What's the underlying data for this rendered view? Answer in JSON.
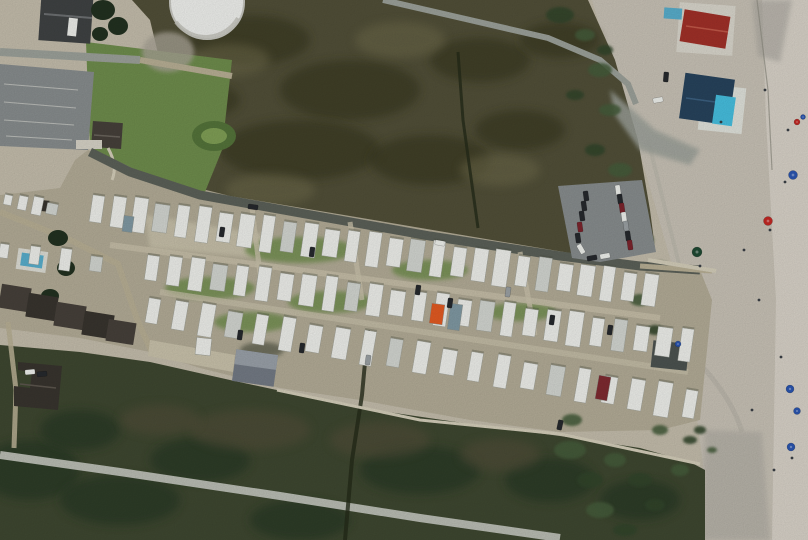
{
  "meta": {
    "description": "Top-down aerial photograph of an oceanfront RV / mobile-home park set between a brown salt marsh and a sandy beach; rows of white travel trailers, a water tank, parking lots, houses with pools, beach boardwalks and beachgoers with umbrellas.",
    "view": "vertical aerial photo",
    "counts": {
      "trailers": 91,
      "houses": 8,
      "pools": 3,
      "parked_cars": 32,
      "beach_umbrellas": 9
    }
  },
  "palette": {
    "white": "#eeefec",
    "beachSand": "#c7c1b5",
    "beachSandLight": "#d8d3c9",
    "beachTrack": "#a7a49d",
    "trackGray": "#b2aea4",
    "duneSand": "#c3bcab",
    "marshNorth": "#514f38",
    "marshNorthDark": "#34341f",
    "marshNorthLight": "#6e6a4b",
    "marshSouth": "#3e4730",
    "marshSouthDark": "#243420",
    "marshSouthBrown": "#55503a",
    "grass": "#6e8c4c",
    "grassDark": "#54733a",
    "grassMoundInner": "#7f9e55",
    "treeDark": "#223120",
    "rvGround": "#b2ab96",
    "laneTan": "#c8c1aa",
    "dirtTan": "#b7ae94",
    "dirtGray": "#a8a395",
    "roadAsphalt": "#5b6058",
    "roadLight": "#9ba099",
    "roadSouth": "#b9bcb3",
    "parkingGray": "#878c8d",
    "trailerWhite": "#edeeea",
    "trailerGray": "#d2d5d0",
    "trailerShadow": "#4e5244",
    "buildingDark": "#3f4243",
    "roofBrown": "#46403a",
    "roofBrown2": "#38342e",
    "officeRoofLight": "#99a0a8",
    "officeRoofDark": "#737a84",
    "shedDark": "#4c5350",
    "redRoof": "#a03028",
    "tealRoof": "#27435c",
    "pool": "#58adcb",
    "poolBright": "#46bede",
    "boardwalk": "#d3cdb9",
    "ditch": "#242a19",
    "carDark": "#26292d",
    "carMaroon": "#7c242c",
    "carWhite": "#eef0ec",
    "carGray": "#9aa0a3",
    "umbBlue": "#2a55b0",
    "umbRed": "#c32823",
    "umbGreen": "#1f4a33",
    "orangeTrailer": "#e25a22",
    "tealTrailer": "#7f98a2",
    "maroonTrailer": "#7e2a30",
    "shrub": "#455c3a",
    "shrubDark": "#31452c",
    "person": "#3a3f45"
  },
  "scene": {
    "trailer_rows": [
      {
        "name": "west-row-1",
        "x0": 8,
        "y0": 200,
        "x1": 52,
        "y1": 209,
        "count": 4,
        "wid": 9,
        "len": 15
      },
      {
        "name": "west-row-2",
        "x0": 4,
        "y0": 251,
        "x1": 96,
        "y1": 264,
        "count": 4,
        "wid": 10,
        "len": 19
      },
      {
        "name": "row-1",
        "x0": 97,
        "y0": 209,
        "x1": 650,
        "y1": 290,
        "count": 27,
        "wid": 13,
        "len": 32
      },
      {
        "name": "row-2",
        "x0": 152,
        "y0": 268,
        "x1": 686,
        "y1": 345,
        "count": 25,
        "wid": 13,
        "len": 30
      },
      {
        "name": "row-3",
        "x0": 153,
        "y0": 311,
        "x1": 690,
        "y1": 404,
        "count": 21,
        "wid": 13,
        "len": 30
      }
    ],
    "special_trailers": [
      {
        "x": 437,
        "y": 314,
        "w": 13,
        "h": 20,
        "a": 8,
        "color": "orangeTrailer"
      },
      {
        "x": 455,
        "y": 317,
        "w": 12,
        "h": 26,
        "a": 8,
        "color": "tealTrailer"
      },
      {
        "x": 603,
        "y": 388,
        "w": 12,
        "h": 24,
        "a": 10,
        "color": "maroonTrailer"
      },
      {
        "x": 128,
        "y": 224,
        "w": 10,
        "h": 16,
        "a": 8,
        "color": "tealTrailer"
      }
    ],
    "parking_cars": [
      {
        "x": 586,
        "y": 196,
        "a": -8,
        "color": "carDark"
      },
      {
        "x": 584,
        "y": 206,
        "a": -8,
        "color": "carDark"
      },
      {
        "x": 582,
        "y": 216,
        "a": -8,
        "color": "carDark"
      },
      {
        "x": 580,
        "y": 227,
        "a": -8,
        "color": "carMaroon"
      },
      {
        "x": 578,
        "y": 238,
        "a": -8,
        "color": "carDark"
      },
      {
        "x": 581,
        "y": 249,
        "a": -30,
        "color": "carWhite"
      },
      {
        "x": 618,
        "y": 190,
        "a": -8,
        "color": "carWhite"
      },
      {
        "x": 620,
        "y": 199,
        "a": -8,
        "color": "carDark"
      },
      {
        "x": 622,
        "y": 208,
        "a": -8,
        "color": "carMaroon"
      },
      {
        "x": 624,
        "y": 217,
        "a": -8,
        "color": "carWhite"
      },
      {
        "x": 626,
        "y": 226,
        "a": -8,
        "color": "carGray"
      },
      {
        "x": 628,
        "y": 236,
        "a": -8,
        "color": "carDark"
      },
      {
        "x": 630,
        "y": 245,
        "a": -8,
        "color": "carMaroon"
      },
      {
        "x": 605,
        "y": 256,
        "a": 80,
        "color": "carWhite"
      },
      {
        "x": 592,
        "y": 258,
        "a": 80,
        "color": "carDark"
      }
    ],
    "road_cars": [
      {
        "x": 440,
        "y": 243,
        "a": 100,
        "color": "carWhite"
      },
      {
        "x": 253,
        "y": 207,
        "a": 98,
        "color": "carDark"
      }
    ],
    "park_cars": [
      {
        "x": 222,
        "y": 232,
        "a": 8,
        "color": "carDark"
      },
      {
        "x": 312,
        "y": 252,
        "a": 8,
        "color": "carDark"
      },
      {
        "x": 418,
        "y": 290,
        "a": 8,
        "color": "carDark"
      },
      {
        "x": 450,
        "y": 303,
        "a": 8,
        "color": "carDark"
      },
      {
        "x": 508,
        "y": 292,
        "a": 8,
        "color": "carGray"
      },
      {
        "x": 552,
        "y": 320,
        "a": 8,
        "color": "carDark"
      },
      {
        "x": 610,
        "y": 330,
        "a": 8,
        "color": "carDark"
      },
      {
        "x": 240,
        "y": 335,
        "a": 8,
        "color": "carDark"
      },
      {
        "x": 302,
        "y": 348,
        "a": 8,
        "color": "carDark"
      },
      {
        "x": 368,
        "y": 360,
        "a": 8,
        "color": "carGray"
      },
      {
        "x": 560,
        "y": 425,
        "a": 12,
        "color": "carDark"
      },
      {
        "x": 666,
        "y": 77,
        "a": 5,
        "color": "carDark"
      },
      {
        "x": 658,
        "y": 100,
        "a": 80,
        "color": "carWhite"
      },
      {
        "x": 30,
        "y": 372,
        "a": 85,
        "color": "carWhite"
      },
      {
        "x": 42,
        "y": 374,
        "a": 85,
        "color": "carDark"
      }
    ],
    "umbrellas": [
      {
        "x": 793,
        "y": 175,
        "r": 4.5,
        "color": "umbBlue"
      },
      {
        "x": 768,
        "y": 221,
        "r": 4.5,
        "color": "umbRed"
      },
      {
        "x": 697,
        "y": 252,
        "r": 5,
        "color": "umbGreen"
      },
      {
        "x": 790,
        "y": 389,
        "r": 4,
        "color": "umbBlue"
      },
      {
        "x": 797,
        "y": 411,
        "r": 3.5,
        "color": "umbBlue"
      },
      {
        "x": 791,
        "y": 447,
        "r": 4,
        "color": "umbBlue"
      },
      {
        "x": 797,
        "y": 122,
        "r": 3,
        "color": "umbRed"
      },
      {
        "x": 803,
        "y": 117,
        "r": 2.5,
        "color": "umbBlue"
      },
      {
        "x": 678,
        "y": 344,
        "r": 3,
        "color": "umbBlue"
      }
    ],
    "people": [
      [
        785,
        182
      ],
      [
        770,
        230
      ],
      [
        759,
        300
      ],
      [
        781,
        357
      ],
      [
        792,
        458
      ],
      [
        700,
        266
      ],
      [
        721,
        122
      ],
      [
        765,
        90
      ],
      [
        788,
        130
      ],
      [
        752,
        410
      ],
      [
        774,
        470
      ],
      [
        744,
        250
      ]
    ],
    "shrubs": [
      [
        560,
        15,
        14,
        8
      ],
      [
        585,
        35,
        10,
        6
      ],
      [
        605,
        50,
        8,
        5
      ],
      [
        600,
        70,
        12,
        7
      ],
      [
        575,
        95,
        9,
        5
      ],
      [
        610,
        110,
        11,
        6
      ],
      [
        595,
        150,
        10,
        6
      ],
      [
        620,
        170,
        12,
        7
      ],
      [
        630,
        210,
        10,
        6
      ],
      [
        645,
        240,
        9,
        5
      ],
      [
        660,
        265,
        8,
        4
      ],
      [
        640,
        300,
        10,
        6
      ],
      [
        655,
        330,
        8,
        5
      ],
      [
        570,
        450,
        16,
        9
      ],
      [
        590,
        480,
        13,
        8
      ],
      [
        615,
        460,
        11,
        7
      ],
      [
        640,
        480,
        12,
        7
      ],
      [
        600,
        510,
        14,
        8
      ],
      [
        655,
        505,
        10,
        6
      ],
      [
        680,
        470,
        9,
        6
      ],
      [
        625,
        530,
        12,
        6
      ],
      [
        660,
        430,
        8,
        5
      ],
      [
        690,
        440,
        7,
        4
      ],
      [
        572,
        420,
        10,
        6
      ],
      [
        700,
        430,
        6,
        4
      ],
      [
        712,
        450,
        5,
        3
      ]
    ],
    "marsh_patches_dark": [
      [
        250,
        40,
        60,
        25
      ],
      [
        350,
        90,
        70,
        30
      ],
      [
        480,
        60,
        50,
        22
      ],
      [
        300,
        150,
        80,
        30
      ],
      [
        430,
        160,
        60,
        25
      ],
      [
        200,
        100,
        40,
        18
      ],
      [
        520,
        130,
        45,
        20
      ],
      [
        560,
        40,
        40,
        18
      ],
      [
        30,
        470,
        50,
        30
      ],
      [
        120,
        500,
        60,
        25
      ],
      [
        80,
        430,
        40,
        20
      ],
      [
        200,
        460,
        50,
        22
      ],
      [
        420,
        470,
        60,
        24
      ],
      [
        300,
        520,
        50,
        20
      ],
      [
        550,
        480,
        45,
        22
      ],
      [
        640,
        500,
        40,
        20
      ]
    ],
    "marsh_patches_light": [
      [
        230,
        60,
        40,
        16
      ],
      [
        400,
        40,
        45,
        18
      ],
      [
        500,
        170,
        40,
        16
      ],
      [
        270,
        190,
        45,
        16
      ],
      [
        180,
        160,
        35,
        14
      ],
      [
        250,
        430,
        60,
        20
      ],
      [
        380,
        440,
        50,
        18
      ],
      [
        500,
        455,
        40,
        16
      ],
      [
        160,
        420,
        40,
        15
      ]
    ],
    "grass_patches": [
      [
        300,
        250,
        55,
        13
      ],
      [
        210,
        288,
        45,
        11
      ],
      [
        430,
        270,
        38,
        10
      ],
      [
        330,
        302,
        42,
        11
      ],
      [
        520,
        312,
        36,
        9
      ],
      [
        252,
        322,
        38,
        10
      ]
    ]
  }
}
